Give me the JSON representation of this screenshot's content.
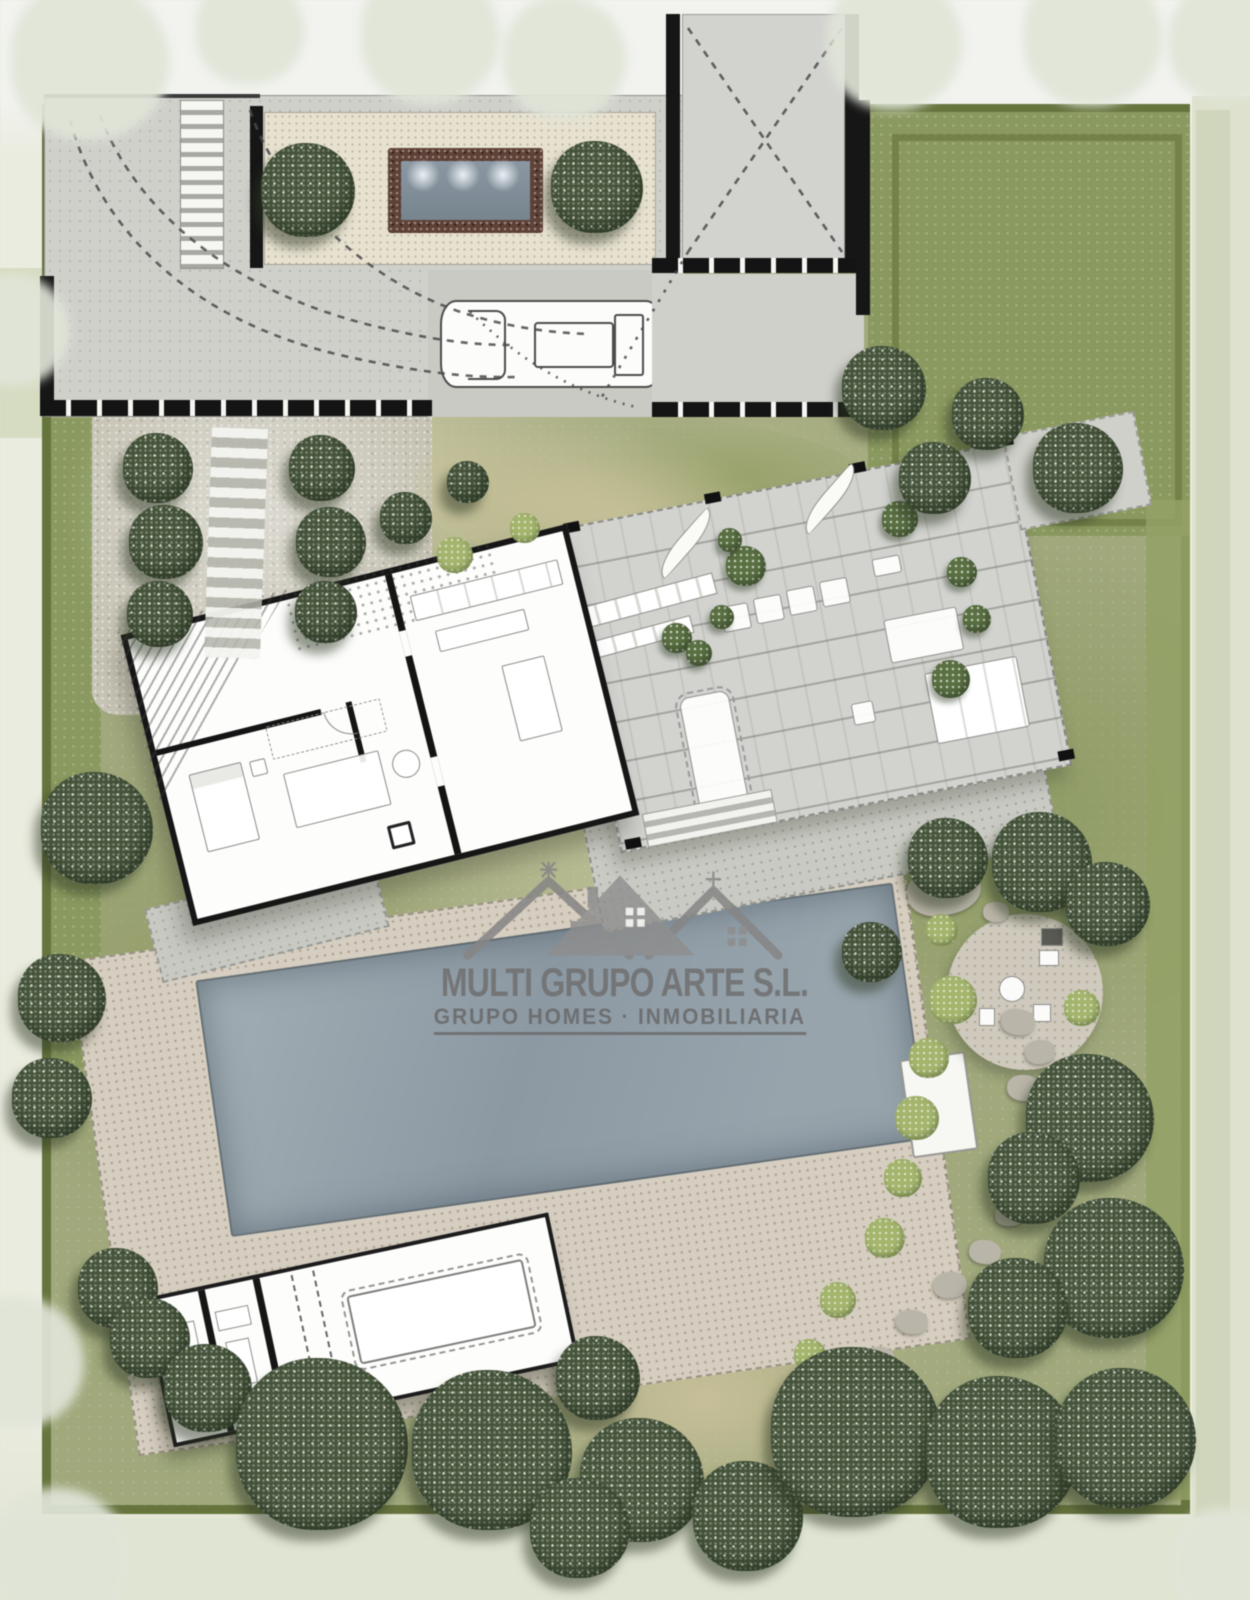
{
  "watermark": {
    "company": "MULTI GRUPO ARTE S.L.",
    "tagline": "GRUPO HOMES · INMOBILIARIA",
    "logo": "triple-roofline-houses-icon",
    "color": "#6f6f6f"
  },
  "palette": {
    "outside": "#eaecdf",
    "plot_border": "#66743e",
    "meadow": "#a0a87c",
    "lawn": "#8a995f",
    "paving_gray": "#cfd0ca",
    "courtyard_gravel": "#e7e1d0",
    "deck_gray": "#d2d3cf",
    "pool_deck_beige": "#d6cec0",
    "pool_water": "#93a1ac",
    "water_feature_border": "#5e4238",
    "tree_dark": "#46553b",
    "tree_pale": "#e0e5d8",
    "wall_black": "#161616"
  },
  "landscape": {
    "stepping_stones": [
      {
        "x": 944,
        "y": 890,
        "w": 74,
        "h": 50,
        "rot": -12
      },
      {
        "x": 996,
        "y": 912,
        "w": 26,
        "h": 20,
        "rot": 0
      },
      {
        "x": 1018,
        "y": 1022,
        "w": 34,
        "h": 26,
        "rot": 8
      },
      {
        "x": 1040,
        "y": 1052,
        "w": 30,
        "h": 24,
        "rot": -6
      },
      {
        "x": 1024,
        "y": 1088,
        "w": 34,
        "h": 26,
        "rot": 4
      },
      {
        "x": 1042,
        "y": 1120,
        "w": 28,
        "h": 22,
        "rot": -8
      },
      {
        "x": 1035,
        "y": 1178,
        "w": 34,
        "h": 26,
        "rot": 6
      },
      {
        "x": 1010,
        "y": 1215,
        "w": 30,
        "h": 22,
        "rot": -4
      },
      {
        "x": 985,
        "y": 1252,
        "w": 32,
        "h": 24,
        "rot": 8
      },
      {
        "x": 950,
        "y": 1285,
        "w": 34,
        "h": 26,
        "rot": -6
      },
      {
        "x": 912,
        "y": 1322,
        "w": 32,
        "h": 24,
        "rot": 5
      },
      {
        "x": 878,
        "y": 1360,
        "w": 34,
        "h": 26,
        "rot": -5
      },
      {
        "x": 846,
        "y": 1398,
        "w": 30,
        "h": 24,
        "rot": 6
      },
      {
        "x": 818,
        "y": 1432,
        "w": 28,
        "h": 22,
        "rot": -4
      }
    ],
    "light_bushes": [
      {
        "x": 953,
        "y": 1000,
        "r": 24
      },
      {
        "x": 929,
        "y": 1058,
        "r": 20
      },
      {
        "x": 917,
        "y": 1118,
        "r": 22
      },
      {
        "x": 903,
        "y": 1178,
        "r": 19
      },
      {
        "x": 885,
        "y": 1238,
        "r": 20
      },
      {
        "x": 1082,
        "y": 1008,
        "r": 18
      },
      {
        "x": 942,
        "y": 930,
        "r": 16
      },
      {
        "x": 838,
        "y": 1300,
        "r": 18
      },
      {
        "x": 810,
        "y": 1355,
        "r": 16
      },
      {
        "x": 455,
        "y": 555,
        "r": 18
      },
      {
        "x": 525,
        "y": 528,
        "r": 15
      }
    ],
    "deck_shrubs": [
      {
        "x": 746,
        "y": 566,
        "r": 20
      },
      {
        "x": 722,
        "y": 617,
        "r": 12
      },
      {
        "x": 677,
        "y": 638,
        "r": 15
      },
      {
        "x": 699,
        "y": 653,
        "r": 13
      },
      {
        "x": 900,
        "y": 519,
        "r": 18
      },
      {
        "x": 962,
        "y": 572,
        "r": 15
      },
      {
        "x": 977,
        "y": 619,
        "r": 14
      },
      {
        "x": 951,
        "y": 679,
        "r": 19
      },
      {
        "x": 730,
        "y": 540,
        "r": 12
      }
    ],
    "dark_trees": [
      {
        "x": 308,
        "y": 190,
        "r": 47
      },
      {
        "x": 597,
        "y": 187,
        "r": 46
      },
      {
        "x": 884,
        "y": 388,
        "r": 42
      },
      {
        "x": 988,
        "y": 414,
        "r": 36
      },
      {
        "x": 1078,
        "y": 468,
        "r": 45
      },
      {
        "x": 935,
        "y": 478,
        "r": 36
      },
      {
        "x": 158,
        "y": 468,
        "r": 35
      },
      {
        "x": 166,
        "y": 542,
        "r": 37
      },
      {
        "x": 160,
        "y": 614,
        "r": 33
      },
      {
        "x": 322,
        "y": 468,
        "r": 33
      },
      {
        "x": 331,
        "y": 542,
        "r": 35
      },
      {
        "x": 326,
        "y": 612,
        "r": 31
      },
      {
        "x": 97,
        "y": 828,
        "r": 56
      },
      {
        "x": 62,
        "y": 998,
        "r": 44
      },
      {
        "x": 52,
        "y": 1098,
        "r": 40
      },
      {
        "x": 406,
        "y": 518,
        "r": 26
      },
      {
        "x": 468,
        "y": 482,
        "r": 21
      },
      {
        "x": 1042,
        "y": 862,
        "r": 50
      },
      {
        "x": 948,
        "y": 858,
        "r": 40
      },
      {
        "x": 1108,
        "y": 904,
        "r": 42
      },
      {
        "x": 872,
        "y": 952,
        "r": 30
      },
      {
        "x": 1090,
        "y": 1118,
        "r": 64
      },
      {
        "x": 1034,
        "y": 1178,
        "r": 46
      },
      {
        "x": 1114,
        "y": 1268,
        "r": 70
      },
      {
        "x": 1018,
        "y": 1308,
        "r": 50
      },
      {
        "x": 118,
        "y": 1288,
        "r": 40
      },
      {
        "x": 150,
        "y": 1338,
        "r": 40
      },
      {
        "x": 208,
        "y": 1388,
        "r": 44
      },
      {
        "x": 598,
        "y": 1378,
        "r": 42
      },
      {
        "x": 322,
        "y": 1444,
        "r": 86
      },
      {
        "x": 492,
        "y": 1450,
        "r": 80
      },
      {
        "x": 642,
        "y": 1480,
        "r": 62
      },
      {
        "x": 748,
        "y": 1516,
        "r": 55
      },
      {
        "x": 856,
        "y": 1432,
        "r": 85
      },
      {
        "x": 1002,
        "y": 1452,
        "r": 76
      },
      {
        "x": 1126,
        "y": 1438,
        "r": 70
      },
      {
        "x": 580,
        "y": 1528,
        "r": 50
      }
    ],
    "pale_trees": [
      {
        "x": 90,
        "y": 60,
        "r": 80
      },
      {
        "x": 250,
        "y": 30,
        "r": 55
      },
      {
        "x": 430,
        "y": 35,
        "r": 70
      },
      {
        "x": 565,
        "y": 58,
        "r": 62
      },
      {
        "x": 895,
        "y": 42,
        "r": 68
      },
      {
        "x": 1093,
        "y": 36,
        "r": 70
      },
      {
        "x": 1228,
        "y": 42,
        "r": 60
      },
      {
        "x": 14,
        "y": 330,
        "r": 56
      },
      {
        "x": 18,
        "y": 1362,
        "r": 66
      },
      {
        "x": 60,
        "y": 1558,
        "r": 70
      },
      {
        "x": 1226,
        "y": 1564,
        "r": 56
      }
    ]
  }
}
